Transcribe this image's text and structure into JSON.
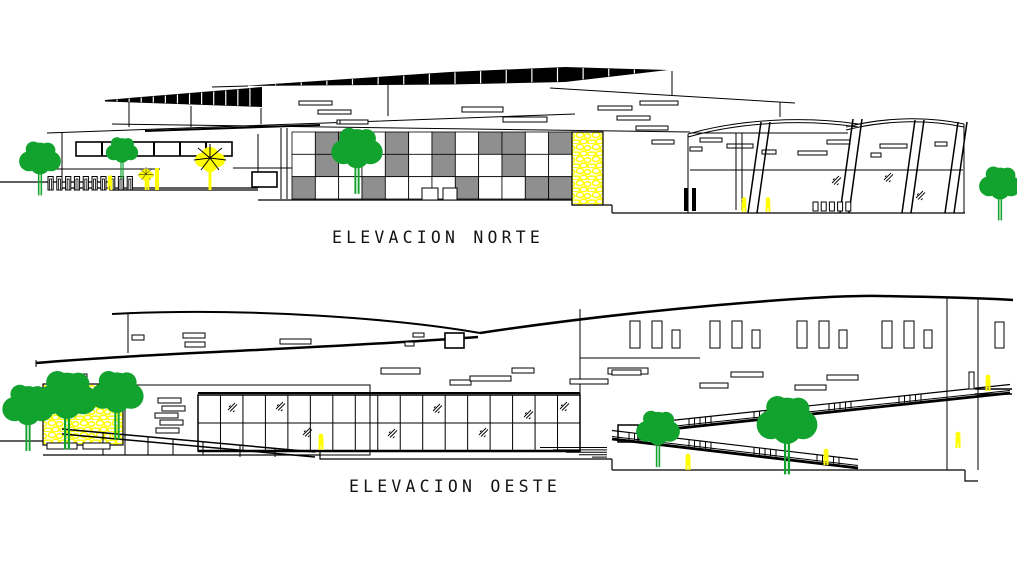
{
  "document": {
    "kind": "architectural elevation drawing",
    "background": "#ffffff"
  },
  "palette": {
    "line_black": "#000000",
    "facade_gray": "#8f8f8f",
    "accent_yellow": "#ffff00",
    "vegetation_green": "#12a22e",
    "text_color": "#141414"
  },
  "labels": {
    "north_title": "ELEVACION NORTE",
    "west_title": "ELEVACION OESTE"
  },
  "north": {
    "checker_pattern": [
      "011010101101",
      "010010100100",
      "100100010011"
    ],
    "louver_left_segments": 13,
    "louver_right_segments": 16,
    "ribbon_window_panes": 6,
    "bollard_count": 10,
    "base_post_count": 5
  },
  "west": {
    "glass_wall_cols": 17,
    "glass_wall_rows": 2,
    "window_group_count": 4,
    "stair_step_count": 5,
    "slit_ladder_count": 5
  }
}
